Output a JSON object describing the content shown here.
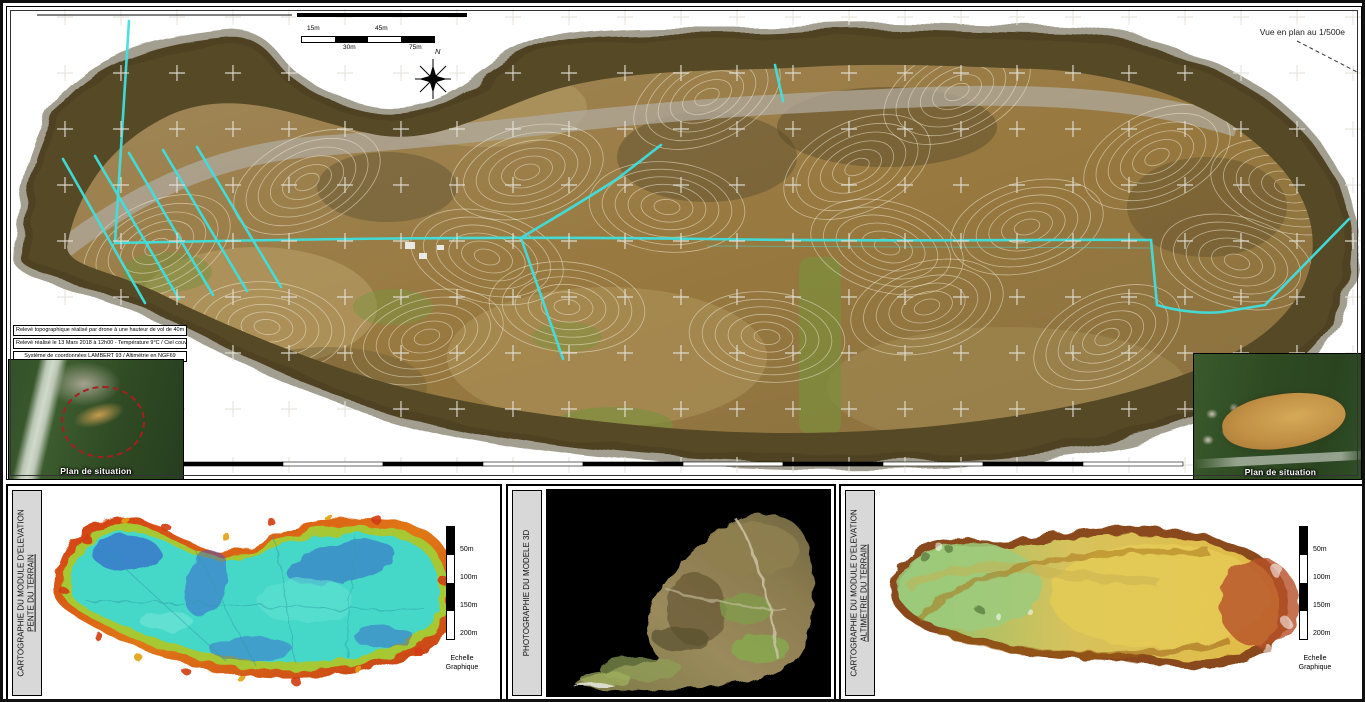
{
  "top_map": {
    "view_label": "Vue en plan au 1/500e",
    "scale_bar": {
      "labels_top": [
        "15m",
        "45m"
      ],
      "labels_bottom": [
        "30m",
        "75m"
      ]
    },
    "compass_label": "N",
    "survey_notes": {
      "line1": "Relevé topographique réalisé par drone à une hauteur de vol de 40m",
      "line2": "Relevé réalisé le 13 Mars 2018 à 12h00 - Température 9°C / Ciel couvert",
      "line3": "Système de coordonnées LAMBERT 93 / Altimétrie en NGF69"
    },
    "insets": {
      "left_label": "Plan de situation",
      "right_label": "Plan de situation"
    }
  },
  "bottom_panels": {
    "slope": {
      "title_line1": "CARTOGRAPHIE DU MODULE D'ELEVATION",
      "title_line2": "PENTE DU TERRAIN"
    },
    "model3d": {
      "title_line1": "PHOTOGRAPHIE DU MODELE 3D"
    },
    "altimetry": {
      "title_line1": "CARTOGRAPHIE DU MODULE D'ELEVATION",
      "title_line2": "ALTIMETRIE DU TERRAIN"
    },
    "scale": {
      "labels": [
        "50m",
        "100m",
        "150m",
        "200m"
      ],
      "caption_line1": "Echelle",
      "caption_line2": "Graphique"
    }
  },
  "colors": {
    "survey_line_cyan": "#3FE0DE",
    "contour_white": "#F3ECD9",
    "terrain_brown": "#96793F",
    "slope_flat_teal": "#45D8C8",
    "slope_steep_red": "#CC3B16",
    "altimetry_low_green": "#8CC06C",
    "altimetry_high_yellow": "#E2BB45"
  }
}
